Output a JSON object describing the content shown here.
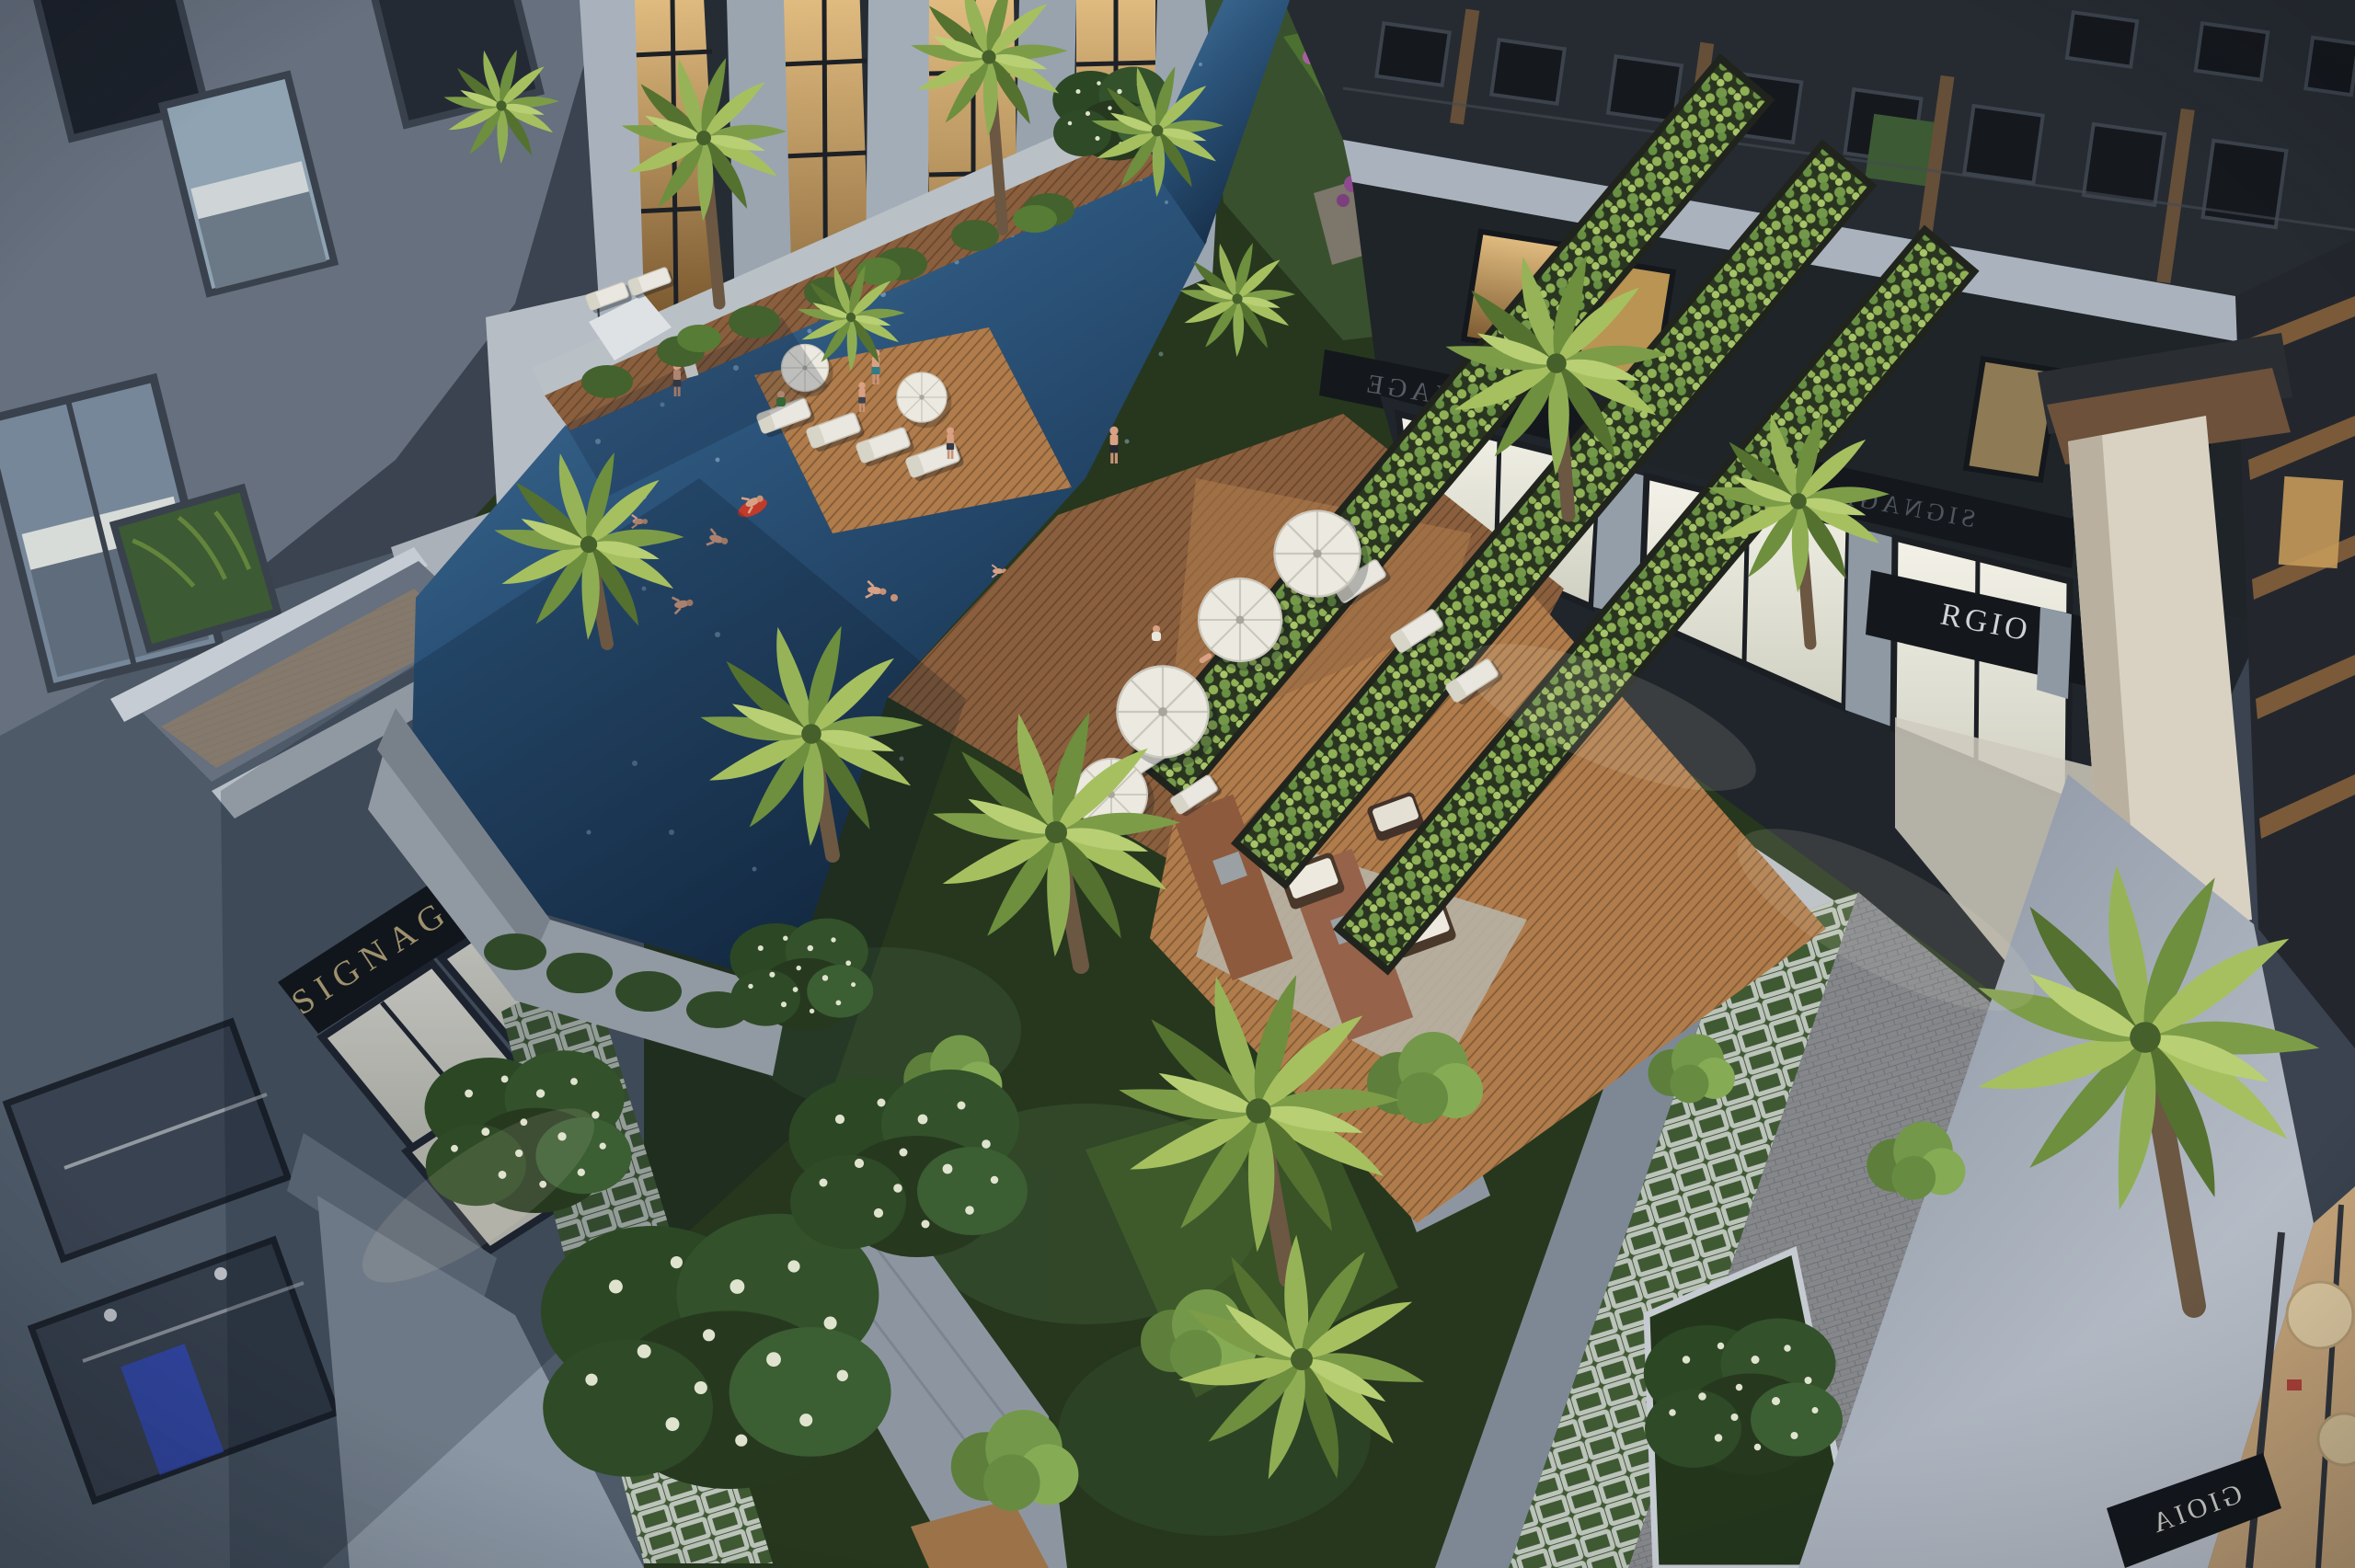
{
  "scene": {
    "label": "courtyard-aerial-render"
  },
  "signage": {
    "left_retail_fascia": "SIGNAGE",
    "right_retail_fascia_upper": "SIGNAGE",
    "right_retail_fascia_lower": "SIGNAGE",
    "right_brand_fragment_left": "RGIO",
    "right_brand_fragment_right": "NI",
    "corner_cafe_fascia": "GIOIA"
  },
  "palette": {
    "pool_water": "#46759e",
    "pool_water_mid": "#2b5379",
    "pool_water_deep": "#142b45",
    "deck_wood": "#8a5f3e",
    "deck_wood_lit": "#b07c4b",
    "pergola_vine": "#8fb055",
    "pergola_frame": "#20241d",
    "palm_light": "#a6c060",
    "palm_mid": "#7d9c48",
    "palm_dark": "#54712f",
    "lawn_green": "#4c7030",
    "garden_dark": "#26371e",
    "left_building_facade": "#66707e",
    "right_building_facade": "#262b31",
    "white_slab": "#aab3bd",
    "storefront_glow": "#f4f2e8",
    "storefront_warm": "#e2bd81",
    "signage_gold": "#c9b583",
    "fascia_dark": "#14181d",
    "embossed_sign": "#555c64",
    "red_poster": "#b8452e",
    "cream_pillar": "#d9d2c2",
    "light_wall": "#c2c8d1",
    "walkway_stone": "#7e8894",
    "paver_grass": "#3f5a33",
    "brick": "#8e5a3d",
    "umbrella_white": "#ece9e1",
    "red_float": "#c23a2a"
  }
}
